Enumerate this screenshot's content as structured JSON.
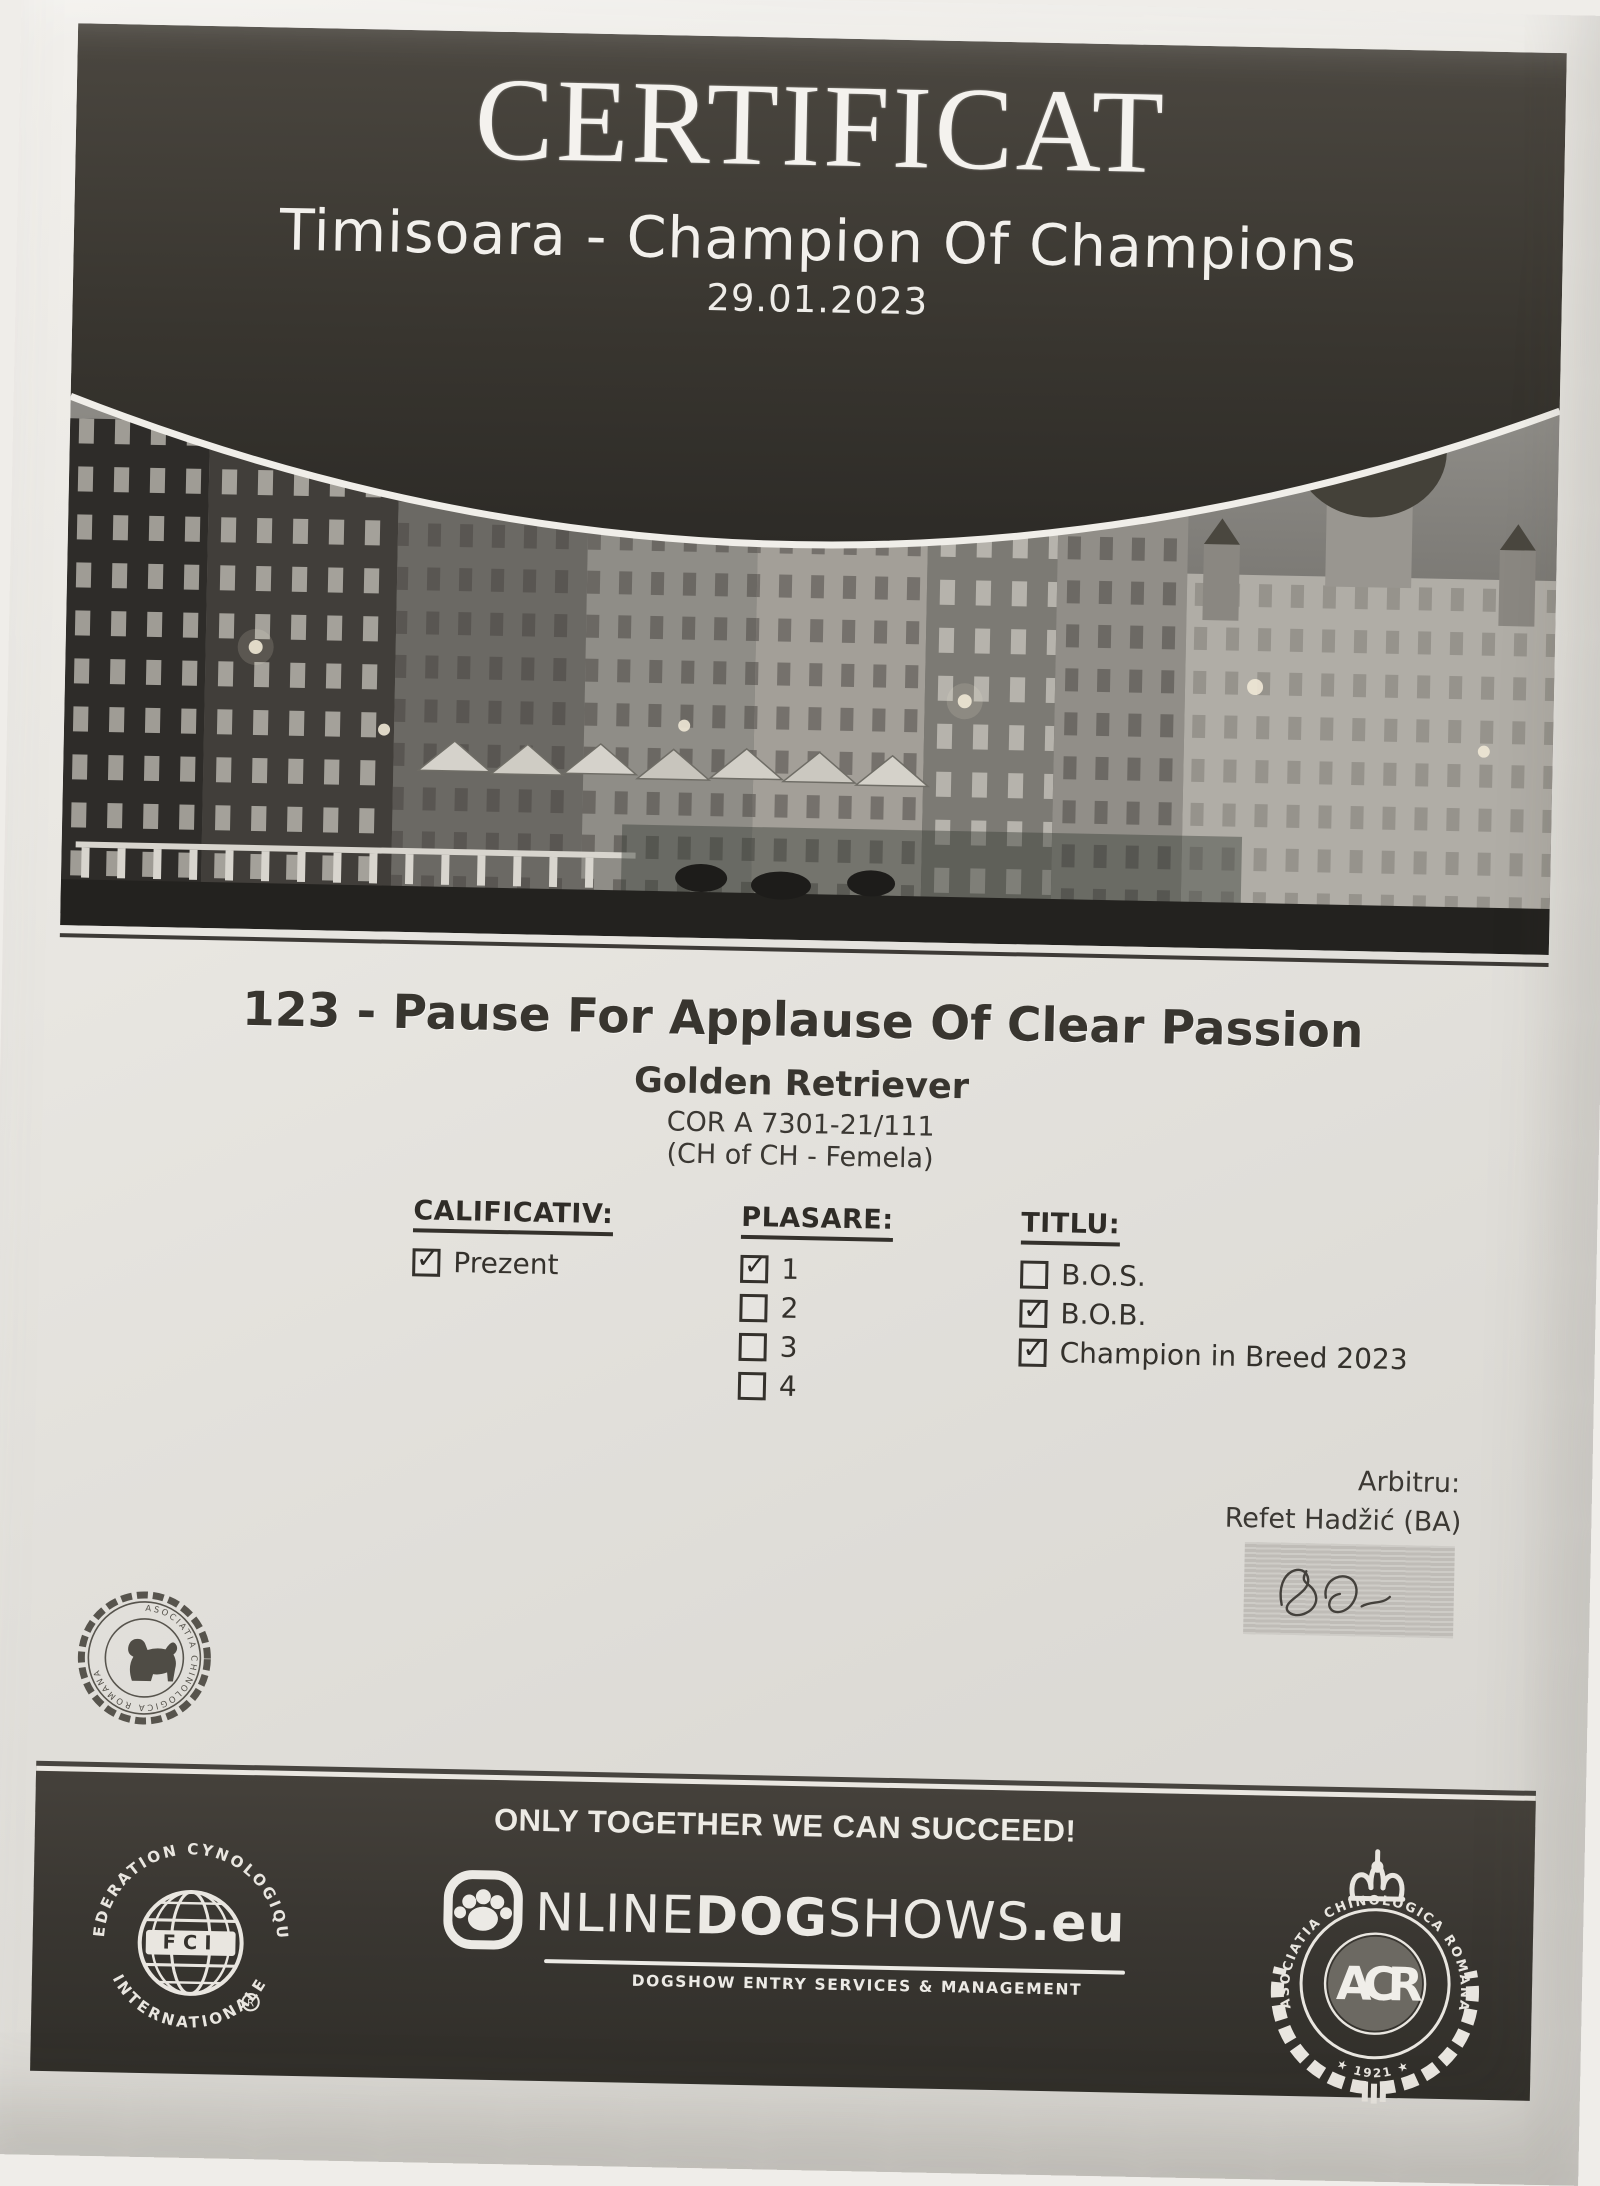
{
  "header": {
    "title": "CERTIFICAT",
    "event": "Timisoara - Champion Of Champions",
    "date": "29.01.2023"
  },
  "entry": {
    "headline": "123 - Pause For Applause Of Clear Passion",
    "breed": "Golden Retriever",
    "registration": "COR A 7301-21/111",
    "class_info": "(CH of CH - Femela)"
  },
  "result_columns": [
    {
      "heading": "CALIFICATIV:",
      "items": [
        {
          "label": "Prezent",
          "mark": "✓"
        }
      ]
    },
    {
      "heading": "PLASARE:",
      "items": [
        {
          "label": "1",
          "mark": "✓"
        },
        {
          "label": "2",
          "mark": ""
        },
        {
          "label": "3",
          "mark": ""
        },
        {
          "label": "4",
          "mark": ""
        }
      ]
    },
    {
      "heading": "TITLU:",
      "items": [
        {
          "label": "B.O.S.",
          "mark": ""
        },
        {
          "label": "B.O.B.",
          "mark": "✓"
        },
        {
          "label": "Champion in Breed 2023",
          "mark": "✓"
        }
      ]
    }
  ],
  "judge": {
    "label": "Arbitru:",
    "name": "Refet Hadžić (BA)"
  },
  "stamp": {
    "ring_text": "ASOCIATIA CHINOLOGICA ROMANA"
  },
  "footer": {
    "slogan": "ONLY TOGETHER WE CAN SUCCEED!",
    "fci": {
      "ring_top": "FEDERATION CYNOLOGIQUE",
      "ring_bottom": "INTERNATIONALE",
      "abbr": "FCI",
      "reg": "R"
    },
    "onlinedogshows": {
      "prefix": "NLINE",
      "bold": "DOG",
      "suffix": "SHOWS",
      "tld": ".eu",
      "tagline": "DOGSHOW ENTRY SERVICES & MANAGEMENT"
    },
    "achr": {
      "ring_text": "ASOCIATIA CHINOLOGICA ROMANA",
      "year": "★ 1921 ★",
      "monogram": "ACR"
    }
  },
  "colors": {
    "ink": "#34312c",
    "band_dark": "#3a3732",
    "paper": "#e7e5e0"
  }
}
